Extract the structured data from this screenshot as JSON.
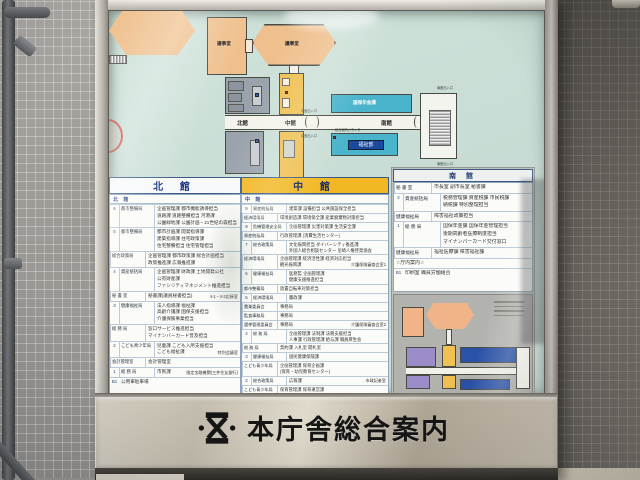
{
  "board": {
    "title": "本庁舎総合案内"
  },
  "plan": {
    "assembly_left": "議事堂",
    "assembly_main": "議事堂",
    "north_label": "北館",
    "center_label": "中館",
    "south_label": "南館",
    "room_insurance": "国保年金課",
    "room_welfare": "福祉部",
    "entrances": {
      "center_top": "中館出入口",
      "center_bottom": "中館出入口",
      "south_top": "南館出入口",
      "south_bottom": "南館出入口",
      "counter": "総合案内カウンター"
    }
  },
  "directory": {
    "north": {
      "header": "北 館",
      "subheader": "北 館",
      "rows": [
        {
          "floor": "6",
          "dept": "都市整備局",
          "lines": [
            "企画管理課 都市機能誘導担当",
            "道路課 道路整備担当 河港課",
            "公園緑地課 公園計画・21世紀の森担当"
          ]
        },
        {
          "floor": "5",
          "dept": "都市整備局",
          "lines": [
            "都市計画課 開発指導課",
            "建築指導課 住宅政策課",
            "住宅整備担当 住宅管理担当"
          ]
        },
        {
          "floor": "",
          "dept": "総合政策局",
          "lines": [
            "企画管理課 都市政策課 総合計画担当",
            "政策推進課 広報推進課"
          ]
        },
        {
          "floor": "4",
          "dept": "資産統括局",
          "lines": [
            "企画管理課 財政課 土地開発公社",
            "公有財産課",
            "ファシリティマネジメント推進担当"
          ]
        },
        {
          "floor": "",
          "dept": "秘 書 室",
          "lines": [
            "秘書課(議員秘書担当)"
          ],
          "note": "4-1・4-2応接室"
        },
        {
          "floor": "3",
          "dept": "健康福祉局",
          "lines": [
            "法人指導課 福祉課",
            "高齢介護課 国保支援担当",
            "介護保険事業担当"
          ]
        },
        {
          "floor": "",
          "dept": "総 務 局",
          "lines": [
            "窓口サービス推進担当",
            "マイナンバーカード普及担当"
          ]
        },
        {
          "floor": "2",
          "dept": "こども青少年局",
          "lines": [
            "児童課 こども入所支援担当",
            "こども福祉課"
          ],
          "note": "特別会議室"
        },
        {
          "floor": "",
          "dept": "会計管理室",
          "lines": [
            "会計管理室"
          ]
        },
        {
          "floor": "1",
          "dept": "総 務 局",
          "lines": [
            "市民課"
          ],
          "note": "指定金融機関(三井住友銀行)"
        },
        {
          "floor": "B1",
          "dept": "",
          "lines": [
            "公用車駐車場"
          ]
        }
      ]
    },
    "center": {
      "header": "中 館",
      "subheader": "中 館",
      "rows": [
        {
          "floor": "9",
          "dept": "資産統括局",
          "lines": [
            "建築課 設備担当 公共施設保全担当"
          ]
        },
        {
          "floor": "",
          "dept": "経済環境局",
          "lines": [
            "環境創造課 環境保全課 産業廃棄物対策担当"
          ]
        },
        {
          "floor": "8",
          "dept": "危機管理安全局",
          "lines": [
            "企画管理課 災害対策課 生活安全課"
          ]
        },
        {
          "floor": "",
          "dept": "資産統括局",
          "lines": [
            "行政管理課 (消費生活センター)"
          ]
        },
        {
          "floor": "7",
          "dept": "総合政策局",
          "lines": [
            "文化振興担当 ダイバーシティ推進課",
            "外国人総合相談センター 尼崎人権啓発協会"
          ]
        },
        {
          "floor": "",
          "dept": "経済環境局",
          "lines": [
            "企画管理課 経済活性課 経済対応担当",
            "観光振興課"
          ],
          "note": "介護保険審査会室1"
        },
        {
          "floor": "6",
          "dept": "健康福祉局",
          "lines": [
            "医務監 企画管理課",
            "健康支援推進担当"
          ]
        },
        {
          "floor": "",
          "dept": "都市整備局",
          "lines": [
            "放置自転車対策担当"
          ]
        },
        {
          "floor": "5",
          "dept": "経済環境局",
          "lines": [
            "農政課"
          ]
        },
        {
          "floor": "",
          "dept": "農業委員会",
          "lines": [
            "事務局"
          ]
        },
        {
          "floor": "",
          "dept": "監査事務局",
          "lines": [
            "事務局"
          ]
        },
        {
          "floor": "",
          "dept": "選挙管理委員会",
          "lines": [
            "事務局"
          ],
          "note": "介護保険審査会室2"
        },
        {
          "floor": "4",
          "dept": "総 務 局",
          "lines": [
            "企画管理課 法制課 法務支援担当",
            "人事課 行政管理課 給与課 職員厚生会"
          ]
        },
        {
          "floor": "",
          "dept": "総 務 局",
          "lines": [
            "契約課 入札室 開札室"
          ]
        },
        {
          "floor": "3",
          "dept": "健康福祉局",
          "lines": [
            "国民健康保険課"
          ]
        },
        {
          "floor": "",
          "dept": "こども青少年局",
          "lines": [
            "企画管理課 保育企画課",
            "(保育・幼児教育センター)"
          ]
        },
        {
          "floor": "2",
          "dept": "総合政策局",
          "lines": [
            "広報課"
          ],
          "note": "市政記者室"
        },
        {
          "floor": "",
          "dept": "こども青少年局",
          "lines": [
            "保育管理課 保育運営課"
          ]
        },
        {
          "floor": "",
          "dept": "総 務 局",
          "lines": [
            "情報公開担当",
            "市民課(市民相談担当)"
          ]
        },
        {
          "floor": "",
          "dept": "庁内施設",
          "lines": [
            "コピー 証明写真 警備室 郵便局"
          ]
        },
        {
          "floor": "B1",
          "dept": "",
          "lines": [
            "公用車駐車場"
          ],
          "note": "売店"
        }
      ]
    },
    "south": {
      "header": "南 館",
      "rows": [
        {
          "floor": "",
          "dept": "秘 書 室",
          "lines": [
            "市長室 副市長室 秘書課"
          ]
        },
        {
          "floor": "2",
          "dept": "資産統括局",
          "lines": [
            "税務管理課 資産税課 市民税課",
            "納税課 特別整理担当"
          ]
        },
        {
          "floor": "",
          "dept": "健康福祉局",
          "lines": [
            "障害福祉政策担当"
          ]
        },
        {
          "floor": "1",
          "dept": "総 務 局",
          "lines": [
            "国保年金課 国保年金管理担当",
            "後期高齢者医療制度担当",
            "マイナンバーカード交付窓口"
          ]
        },
        {
          "floor": "",
          "dept": "健康福祉局",
          "lines": [
            "福祉医療課 障害福祉課"
          ]
        },
        {
          "floor": "",
          "dept": "",
          "lines": [
            "☆庁内案内☆"
          ]
        },
        {
          "floor": "B1",
          "dept": "",
          "lines": [
            "印刷室 職員労働組合"
          ]
        }
      ]
    }
  }
}
